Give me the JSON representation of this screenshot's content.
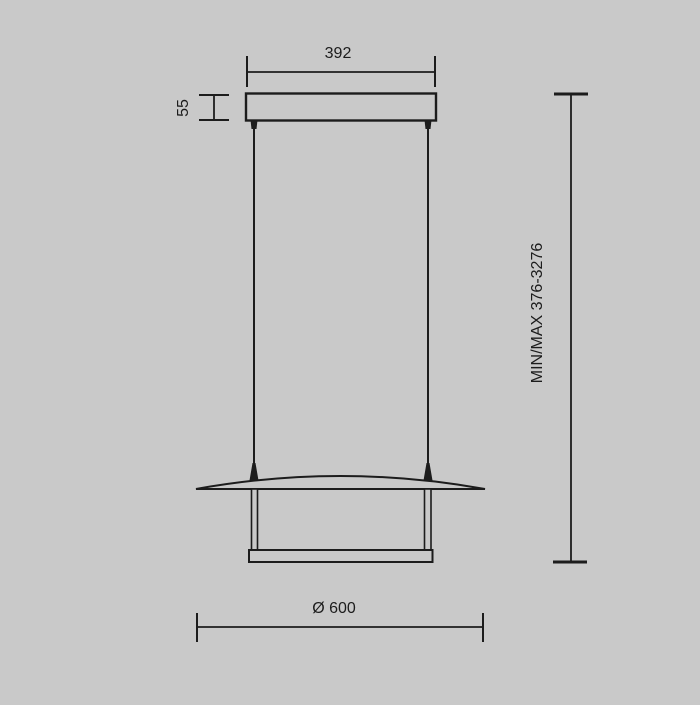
{
  "drawing": {
    "labels": {
      "canopy_width": "392",
      "canopy_height": "55",
      "suspension_range": "MIN/MAX 376-3276",
      "diameter": "Ø 600"
    },
    "colors": {
      "background": "#c9c9c9",
      "line": "#1c1c1c"
    }
  }
}
